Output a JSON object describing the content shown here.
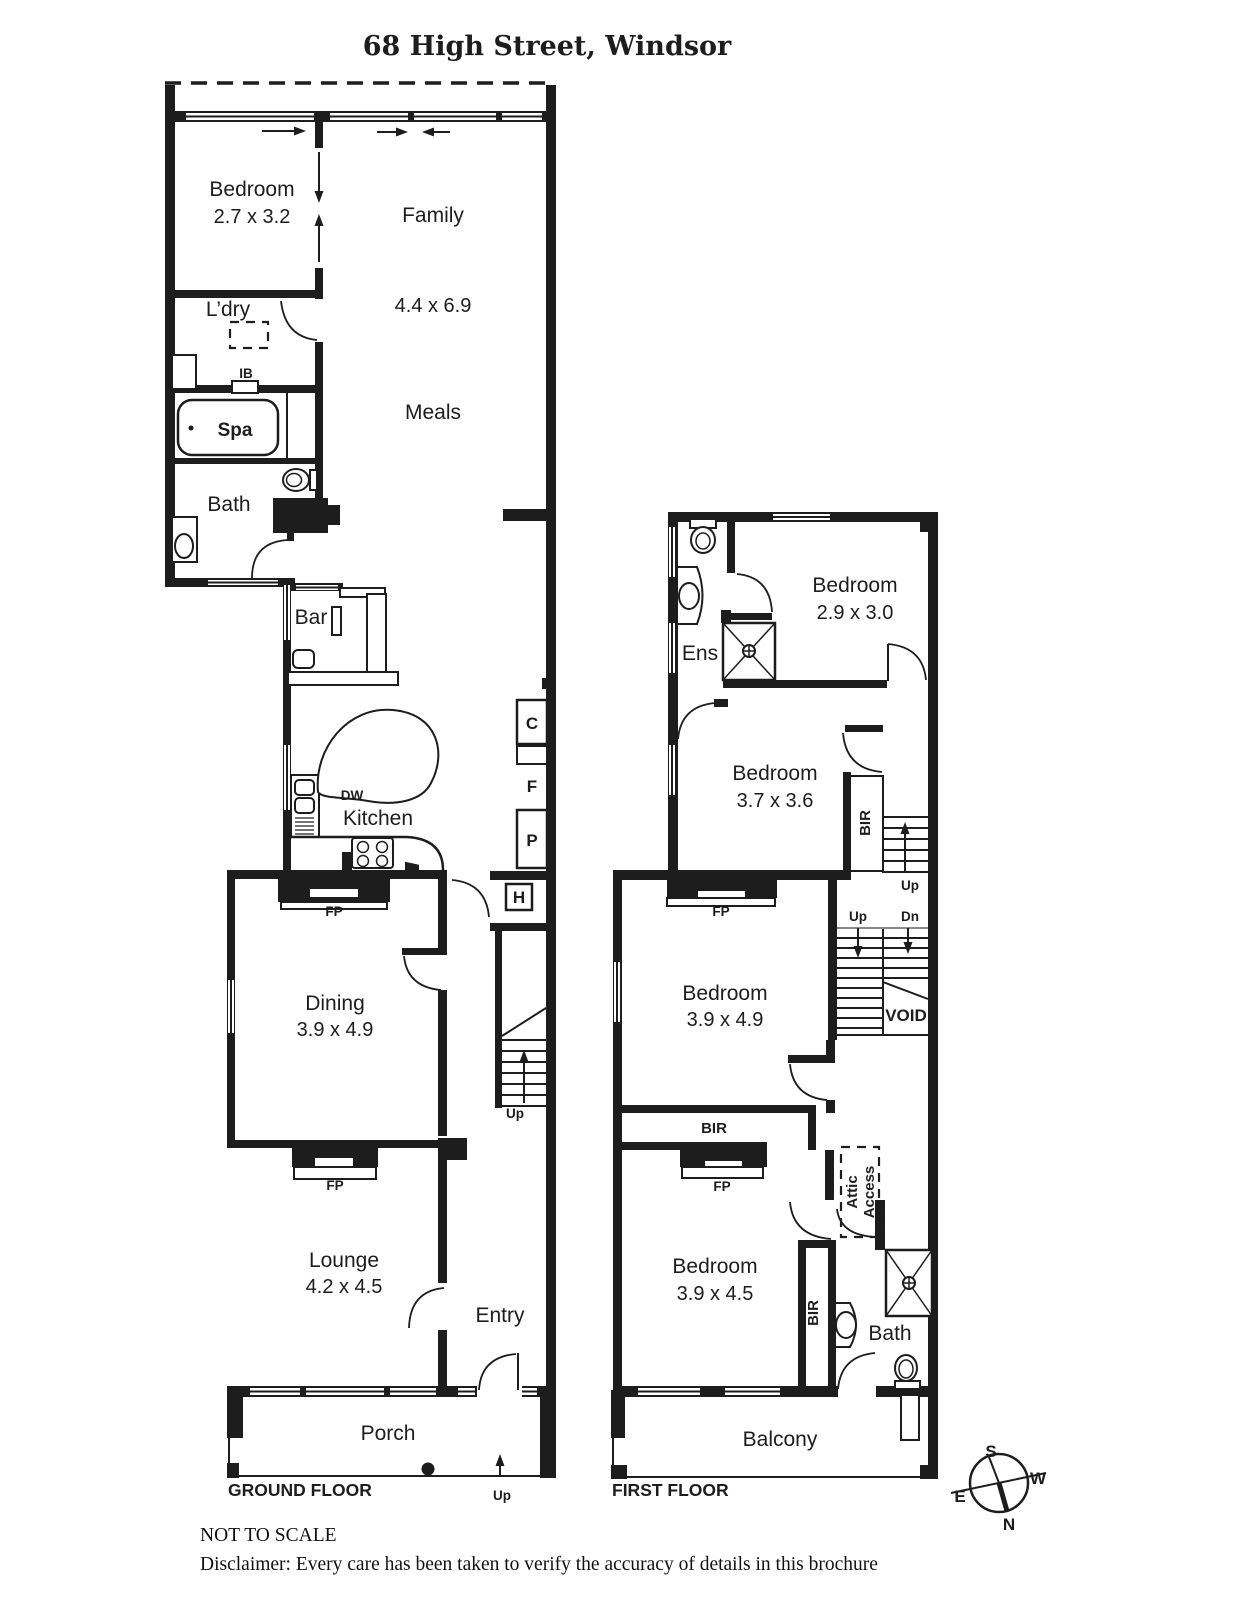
{
  "title": "68 High Street, Windsor",
  "ground": {
    "floor_label": "GROUND FLOOR",
    "bedroom": {
      "name": "Bedroom",
      "dims": "2.7 x 3.2"
    },
    "family": {
      "name": "Family",
      "dims": "4.4 x 6.9"
    },
    "meals": "Meals",
    "laundry": "L’dry",
    "spa": "Spa",
    "bath": "Bath",
    "ib": "IB",
    "bar": "Bar",
    "dw": "DW",
    "kitchen": "Kitchen",
    "dining": {
      "name": "Dining",
      "dims": "3.9 x 4.9"
    },
    "lounge": {
      "name": "Lounge",
      "dims": "4.2 x 4.5"
    },
    "entry": "Entry",
    "porch": "Porch",
    "fp_dining": "FP",
    "fp_lounge": "FP",
    "cupboard": "C",
    "fridge": "F",
    "pantry": "P",
    "hws": "H",
    "up_stairs": "Up",
    "up_porch": "Up"
  },
  "first": {
    "floor_label": "FIRST FLOOR",
    "bedroom1": {
      "name": "Bedroom",
      "dims": "2.9 x 3.0"
    },
    "ens": "Ens",
    "bedroom2": {
      "name": "Bedroom",
      "dims": "3.7 x 3.6"
    },
    "bedroom3": {
      "name": "Bedroom",
      "dims": "3.9 x 4.9"
    },
    "bedroom4": {
      "name": "Bedroom",
      "dims": "3.9 x 4.5"
    },
    "bath": "Bath",
    "balcony": "Balcony",
    "void": "VOID",
    "attic_line1": "Attic",
    "attic_line2": "Access",
    "bir_bed2": "BIR",
    "bir_bed3": "BIR",
    "bir_bed4": "BIR",
    "fp_bed3": "FP",
    "fp_bed4": "FP",
    "up_top": "Up",
    "up_mid": "Up",
    "dn": "Dn"
  },
  "compass": {
    "s": "S",
    "w": "W",
    "e": "E",
    "n": "N"
  },
  "footer": {
    "scale_note": "NOT TO SCALE",
    "disclaimer": "Disclaimer: Every care has been taken to verify the accuracy of details in this brochure"
  }
}
